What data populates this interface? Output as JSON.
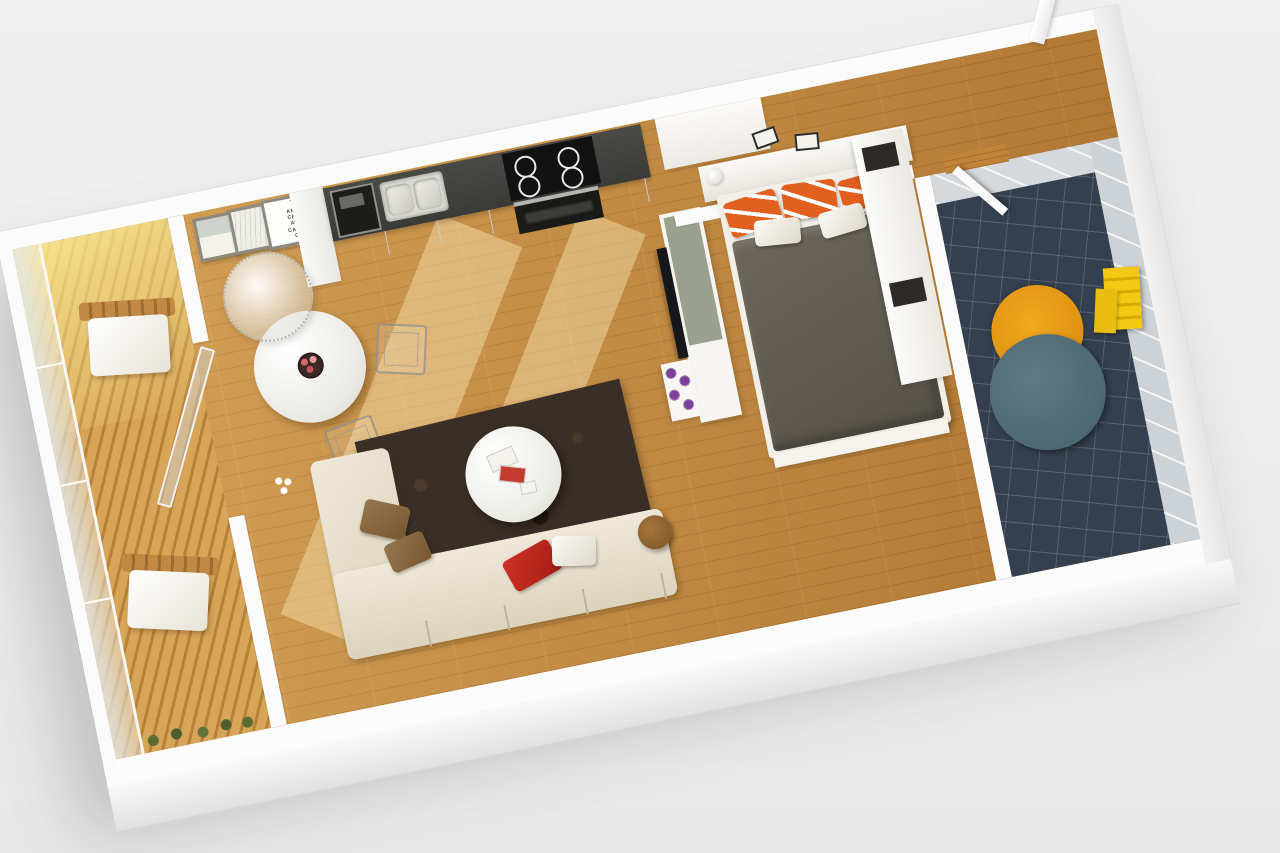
{
  "scene": {
    "description": "3D isometric cutaway floor plan render of a studio apartment on a light gray background, rotated about 11 degrees",
    "background_color": "#ececec",
    "wall_color": "#fbfbfb",
    "wood_floor_color": "#c08439",
    "poster": {
      "crown_symbol": "♛",
      "lines": [
        "KEEP",
        "CALM",
        "AND",
        "CARRY",
        "ON"
      ]
    },
    "palette": {
      "balcony_deck": "#cf9a4e",
      "balcony_sun_glow": "#fcee96",
      "kitchen_counter": "#3a3a37",
      "rug_living": "#3a2f27",
      "sofa": "#efe8d8",
      "pillow_red": "#cf3125",
      "pillow_orange_stripe": "#e2601f",
      "bed_duvet": "#5f5a50",
      "bathroom_floor_tile": "#34404f",
      "bathroom_wall_tile": "#d5d9dc",
      "bathroom_rug_orange": "#f0a81e",
      "bathroom_tub_teal": "#53707a",
      "towel_yellow": "#f4c914",
      "tv_panel": "#16171b",
      "candles_purple": "#7c3f9d",
      "divider_top_sage": "#9aa08e"
    },
    "rooms": [
      {
        "name": "balcony",
        "items": [
          "glass-railing",
          "wood-decking",
          "sun-glow",
          "lounge-chair-upper",
          "lounge-chair-lower",
          "plants"
        ]
      },
      {
        "name": "living-dining-kitchen",
        "items": [
          "keep-calm-poster",
          "picture-frame-photo",
          "picture-frame-scribble",
          "kitchen-counter",
          "coffee-machine",
          "double-sink",
          "cooktop-4-burners",
          "oven",
          "pendant-wicker-lamp",
          "round-dining-table",
          "fruit-bowl",
          "wire-chair-1",
          "wire-chair-2",
          "open-balcony-glass-door",
          "flower-vase",
          "dark-brown-shag-rug",
          "round-coffee-table",
          "magazines",
          "wood-stool",
          "l-shaped-cream-sofa",
          "brown-pillows",
          "red-pillow",
          "white-pillow",
          "sunlight-streaks"
        ]
      },
      {
        "name": "bedroom",
        "items": [
          "tv-divider-wall",
          "flat-tv",
          "purple-candles",
          "headboard-shelf",
          "table-lamp",
          "wall-frames",
          "double-bed",
          "gray-duvet",
          "orange-striped-pillows-x3",
          "white-pillows-x2",
          "foot-bench",
          "white-wardrobe"
        ]
      },
      {
        "name": "entry-hall",
        "items": [
          "wood-floor",
          "closet",
          "open-entry-door"
        ]
      },
      {
        "name": "bathroom",
        "items": [
          "navy-tile-floor",
          "white-tile-walls",
          "open-bathroom-door",
          "orange-round-rug",
          "teal-round-tub",
          "yellow-towels"
        ]
      }
    ],
    "kitchen": {
      "burner_count": 4,
      "sink_basins": 2
    },
    "bedroom": {
      "orange_striped_pillow_count": 3,
      "white_pillow_count": 2
    },
    "dining": {
      "chair_count": 2
    }
  }
}
